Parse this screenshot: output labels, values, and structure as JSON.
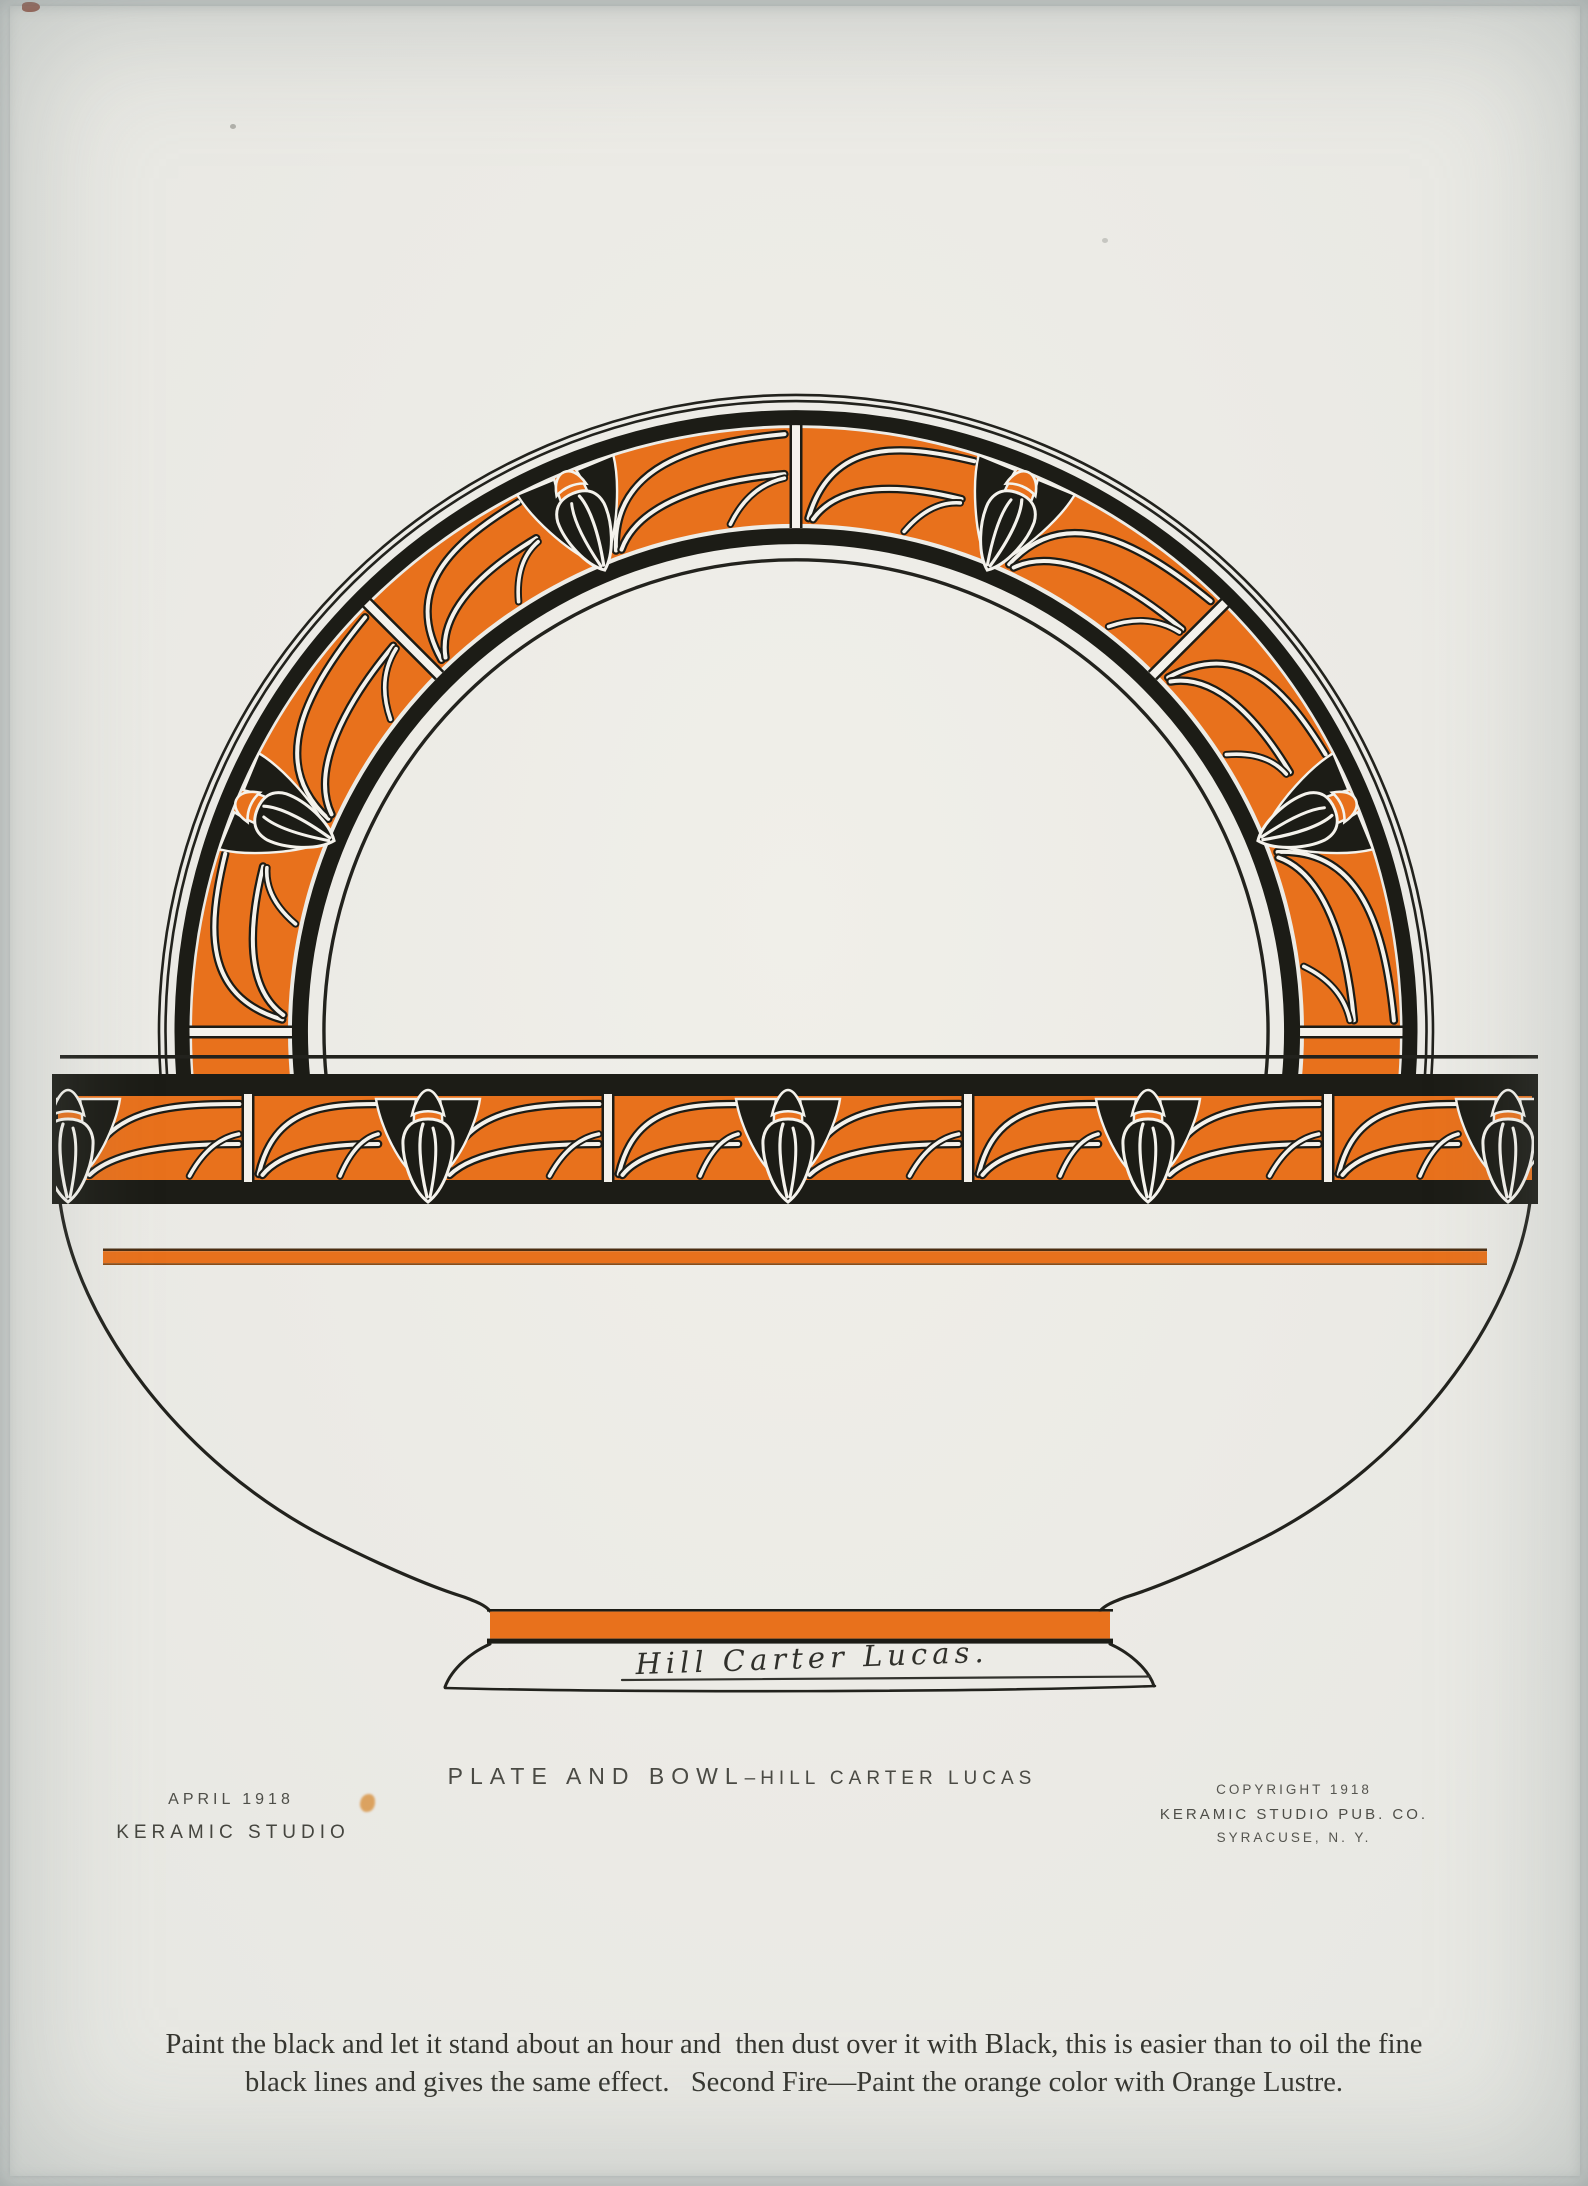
{
  "colors": {
    "orange": "#E8711C",
    "black": "#1C1C16",
    "paper": "#F1EFE9",
    "stripe_edge_dark": "#4A2D12",
    "stripe_edge_light": "#8A4C17",
    "outline_ink": "#22221D",
    "signature_ink": "#33332E"
  },
  "caption": {
    "title": "PLATE AND BOWL",
    "separator": "–",
    "designer": "HILL CARTER LUCAS"
  },
  "issue": {
    "month_year": "APRIL 1918",
    "publication": "KERAMIC STUDIO"
  },
  "copyright": {
    "line1": "COPYRIGHT 1918",
    "line2": "KERAMIC STUDIO PUB. CO.",
    "line3": "SYRACUSE, N. Y."
  },
  "signature": "Hill Carter Lucas.",
  "instructions": {
    "line1": "Paint the black and let it stand about an hour and  then dust over it with Black, this is easier than to oil the fine",
    "line2": "black lines and gives the same effect.   Second Fire—Paint the orange color with Orange Lustre."
  }
}
